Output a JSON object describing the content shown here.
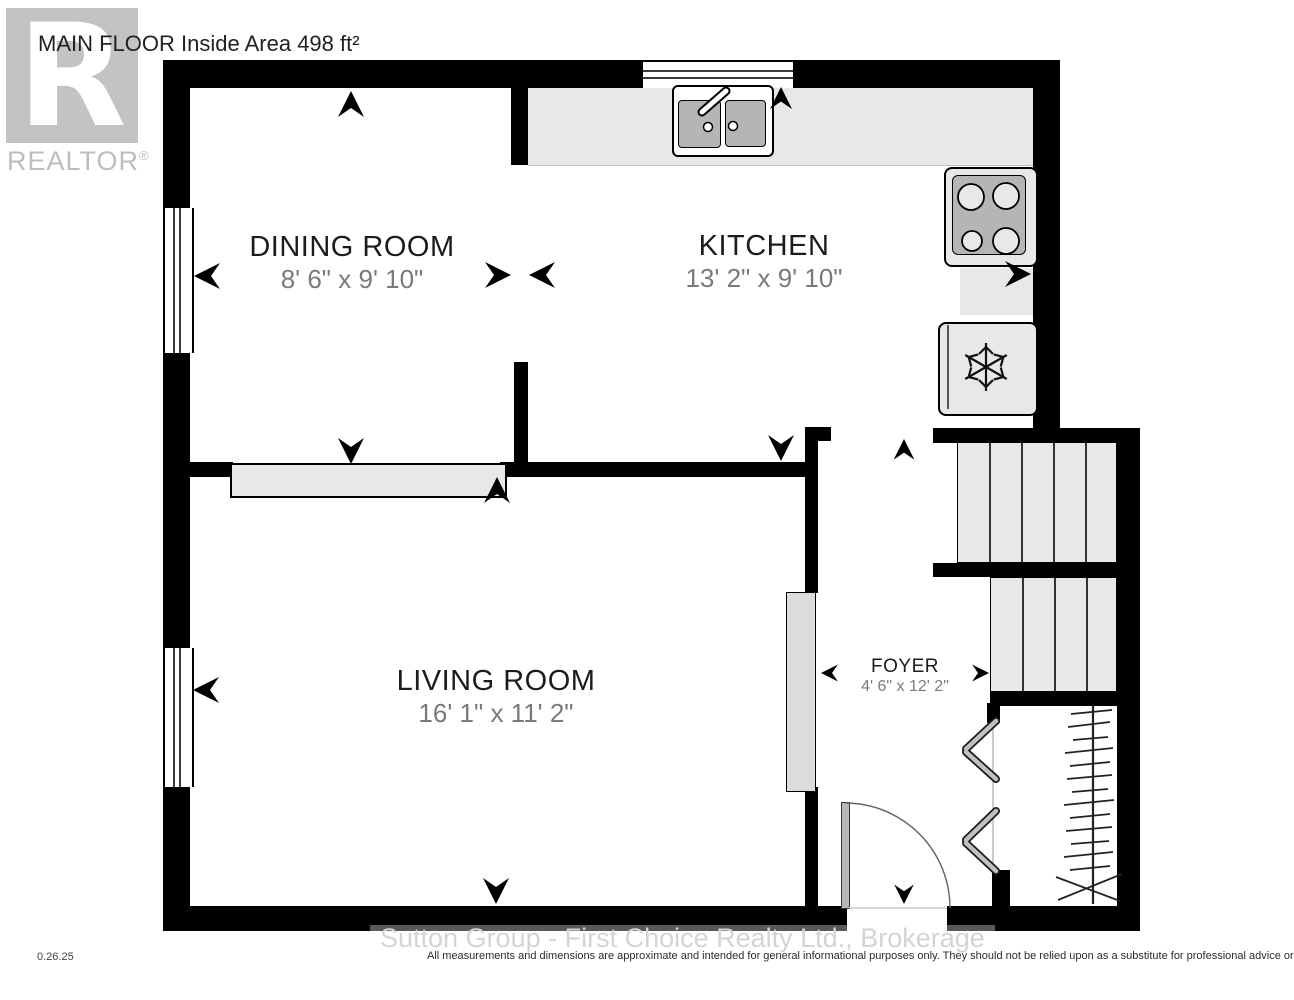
{
  "header": {
    "title": "MAIN FLOOR Inside Area 498 ft²",
    "logo": {
      "letter": "R",
      "wordmark": "REALTOR",
      "registered": "®"
    }
  },
  "rooms": [
    {
      "name": "DINING ROOM",
      "dims": "8' 6\" x 9' 10\""
    },
    {
      "name": "KITCHEN",
      "dims": "13' 2\" x 9' 10\""
    },
    {
      "name": "LIVING ROOM",
      "dims": "16' 1\" x 11' 2\""
    },
    {
      "name": "FOYER",
      "dims": "4' 6\" x 12' 2\""
    }
  ],
  "fixtures": [
    "double-sink",
    "faucet",
    "stove-4-burner",
    "refrigerator-snowflake",
    "stairs-upper-flight",
    "stairs-lower-flight",
    "entry-door-swing",
    "closet-bifold-doors",
    "closet-hanging-rod",
    "window",
    "opening-arrow"
  ],
  "footer": {
    "date_code": "0.26.25",
    "watermark": "Sutton Group - First Choice Realty Ltd., Brokerage",
    "disclaimer": "All measurements and dimensions are approximate and intended for general informational purposes only. They should not be relied upon as a substitute for professional advice or accurate surveying."
  },
  "colors": {
    "wall": "#000000",
    "fixture_fill": "#e8e8e8",
    "fixture_dark": "#b5b5b5",
    "room_label": "#1c1c1c",
    "dim_label": "#7a7a7a",
    "logo_gray": "#c3c3c3",
    "watermark_gray": "#d4d4d4"
  }
}
